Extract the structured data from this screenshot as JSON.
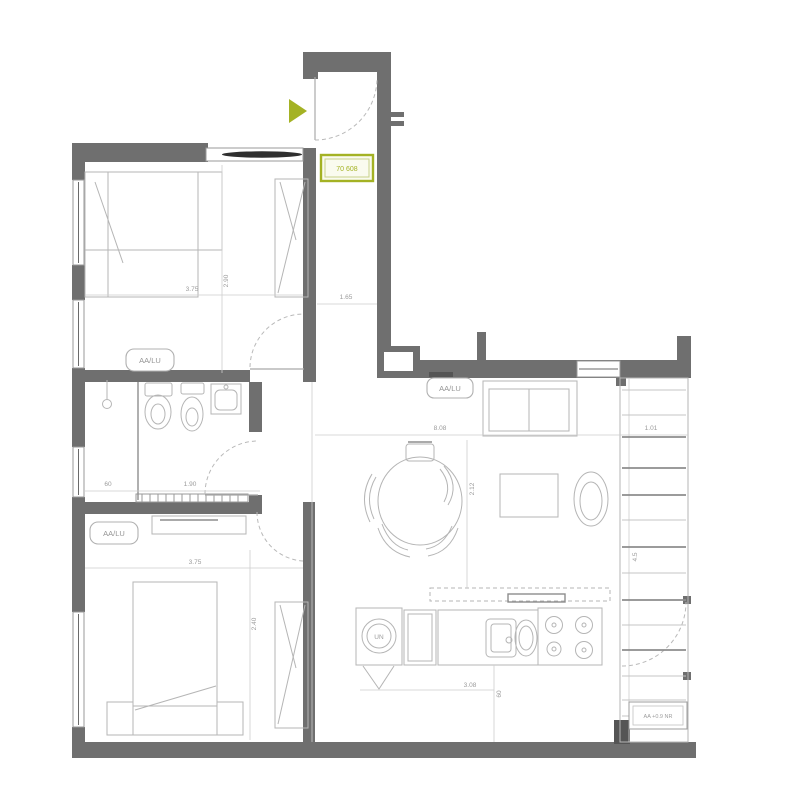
{
  "unit_tag": {
    "text": "70 608"
  },
  "elevation_tag": {
    "text": "AA +0.9 NR"
  },
  "room_labels": {
    "bedroom_top": "AA/LU",
    "bedroom_bottom": "AA/LU",
    "living_room": "AA/LU"
  },
  "dimensions": {
    "bedroom_top_width": "3.75",
    "bedroom_top_depth": "2.90",
    "corridor_width": "1.65",
    "living_width": "8.08",
    "living_depth": "2.12",
    "balcony_width": "1.01",
    "balcony_depth": "4.5",
    "bathroom_width": "1.90",
    "closet_width": "60",
    "bedroom_bottom_width": "3.75",
    "bedroom_bottom_depth": "2.40",
    "kitchen_width": "3.08",
    "kitchen_offset": "60"
  },
  "appliances": {
    "washer_label": "UN"
  },
  "colors": {
    "wall": "#6f6f6f",
    "accent": "#a4b224",
    "accent-fill": "#fafbef",
    "line": "#b5b5b5",
    "line-dark": "#8d8d8d",
    "dim-text": "#9b9b9b",
    "glass": "#2f2f2f"
  }
}
